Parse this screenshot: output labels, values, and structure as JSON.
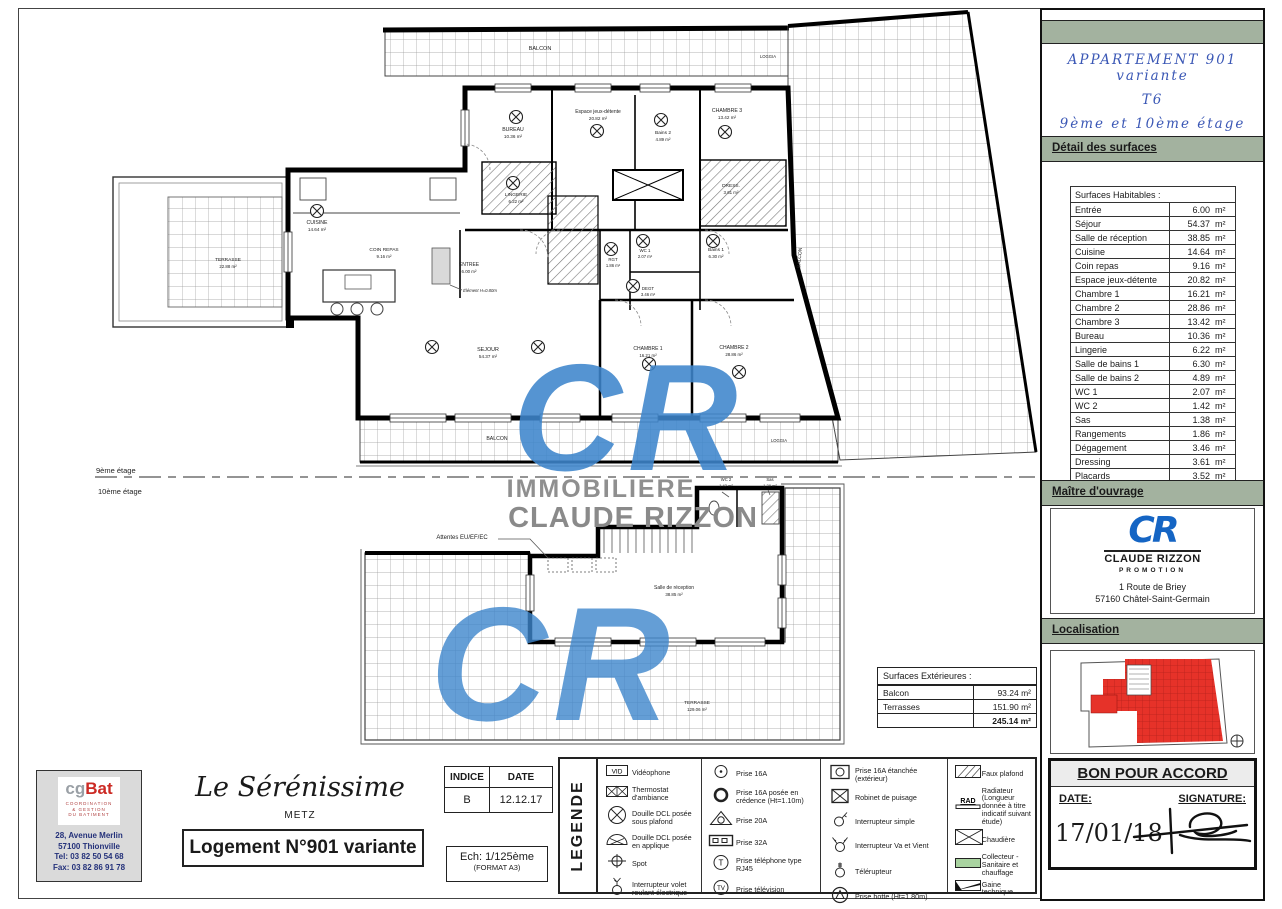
{
  "colors": {
    "band_green": "#a3b29f",
    "title_blue": "#3a57b5",
    "logo_blue": "#1565c4",
    "watermark_blue": "#3e86cc",
    "map_red": "#e63229",
    "gbat_red": "#cc2a24"
  },
  "apartment_title": {
    "line1": "APPARTEMENT 901 variante",
    "line2": "T6",
    "line3": "9ème et 10ème étage"
  },
  "detail_surfaces": {
    "heading": "Détail des surfaces",
    "table_header": "Surfaces Habitables :",
    "unit": "m²",
    "rows": [
      {
        "l": "Entrée",
        "v": "6.00"
      },
      {
        "l": "Séjour",
        "v": "54.37"
      },
      {
        "l": "Salle de réception",
        "v": "38.85"
      },
      {
        "l": "Cuisine",
        "v": "14.64"
      },
      {
        "l": "Coin repas",
        "v": "9.16"
      },
      {
        "l": "Espace jeux-détente",
        "v": "20.82"
      },
      {
        "l": "Chambre 1",
        "v": "16.21"
      },
      {
        "l": "Chambre 2",
        "v": "28.86"
      },
      {
        "l": "Chambre 3",
        "v": "13.42"
      },
      {
        "l": "Bureau",
        "v": "10.36"
      },
      {
        "l": "Lingerie",
        "v": "6.22"
      },
      {
        "l": "Salle de bains 1",
        "v": "6.30"
      },
      {
        "l": "Salle de bains 2",
        "v": "4.89"
      },
      {
        "l": "WC 1",
        "v": "2.07"
      },
      {
        "l": "WC 2",
        "v": "1.42"
      },
      {
        "l": "Sas",
        "v": "1.38"
      },
      {
        "l": "Rangements",
        "v": "1.86"
      },
      {
        "l": "Dégagement",
        "v": "3.46"
      },
      {
        "l": "Dressing",
        "v": "3.61"
      },
      {
        "l": "Placards",
        "v": "3.52"
      }
    ],
    "total": "247.42"
  },
  "maitre_ouvrage": {
    "heading": "Maître d'ouvrage",
    "logo": "CR",
    "company": "CLAUDE RIZZON",
    "company_sub": "PROMOTION",
    "address1": "1 Route de Briey",
    "address2": "57160 Châtel-Saint-Germain"
  },
  "localisation": {
    "heading": "Localisation"
  },
  "bon_pour_accord": {
    "heading": "BON POUR ACCORD",
    "date_label": "DATE:",
    "signature_label": "SIGNATURE:",
    "date_value": "17/01/18"
  },
  "title_block": {
    "gbat": {
      "logo_cg": "cg",
      "logo_bat": "Bat",
      "sub1": "COORDINATION",
      "sub2": "& GESTION",
      "sub3": "DU BATIMENT",
      "addr1": "28, Avenue Merlin",
      "addr2": "57100 Thionville",
      "addr3": "Tel: 03 82 50 54 68",
      "addr4": "Fax: 03 82 86 91 78"
    },
    "project": {
      "name": "Le Sérénissime",
      "city": "METZ",
      "logement": "Logement N°901 variante"
    },
    "indice": {
      "h1": "INDICE",
      "h2": "DATE",
      "v1": "B",
      "v2": "12.12.17"
    },
    "scale": {
      "line1": "Ech: 1/125ème",
      "line2": "(FORMAT A3)"
    },
    "legende_label": "LEGENDE",
    "glyphs": {
      "vid": "VID",
      "tel": "T",
      "tv": "TV",
      "rad": "RAD"
    },
    "legend": {
      "c1": [
        {
          "label": "Vidéophone"
        },
        {
          "label": "Thermostat d'ambiance"
        },
        {
          "label": "Douille DCL posée sous plafond"
        },
        {
          "label": "Douille DCL posée en applique"
        },
        {
          "label": "Spot"
        },
        {
          "label": "Interrupteur volet roulant électrique"
        }
      ],
      "c2": [
        {
          "label": "Prise 16A"
        },
        {
          "label": "Prise 16A posée en crédence (Ht=1.10m)"
        },
        {
          "label": "Prise 20A"
        },
        {
          "label": "Prise 32A"
        },
        {
          "label": "Prise téléphone type RJ45"
        },
        {
          "label": "Prise télévision"
        }
      ],
      "c3": [
        {
          "label": "Prise 16A étanchée (extérieur)"
        },
        {
          "label": "Robinet de puisage"
        },
        {
          "label": "Interrupteur simple"
        },
        {
          "label": "Interrupteur Va et Vient"
        },
        {
          "label": "Télérupteur"
        },
        {
          "label": "Prise hotte (Ht=1.80m)"
        }
      ],
      "c4": [
        {
          "label": "Faux plafond"
        },
        {
          "label": "Radiateur (Longueur donnée à titre indicatif suivant étude)"
        },
        {
          "label": "Chaudière"
        },
        {
          "label": "Collecteur - Sanitaire et chauffage"
        },
        {
          "label": "Gaine technique"
        }
      ]
    }
  },
  "plan": {
    "floor9_label": "9ème étage",
    "floor10_label": "10ème étage",
    "attentes_label": "Attentes EU/EF/EC",
    "element_label": "Élément H=0.80m",
    "labels": {
      "balcon_top": "BALCON",
      "balcon_bottom": "BALCON",
      "balcon_side": "BALCON",
      "loggia_top": "LOGGIA",
      "loggia_bottom": "LOGGIA",
      "terrasse9": "TERRASSE",
      "terrasse9_area": "22.88 m²",
      "terrasse10": "TERRASSE",
      "terrasse10_area": "129.06 m²"
    },
    "rooms9": {
      "bureau": {
        "name": "BUREAU",
        "area": "10.36 m²"
      },
      "jeux": {
        "name": "Espace jeux-détente",
        "area": "20.82 m²"
      },
      "bains2": {
        "name": "Bains 2",
        "area": "4.89 m²"
      },
      "chambre3": {
        "name": "CHAMBRE 3",
        "area": "13.42 m²"
      },
      "bains1": {
        "name": "Bains 1",
        "area": "6.30 m²"
      },
      "lingerie": {
        "name": "LINGERIE",
        "area": "6.22 m²"
      },
      "dressing": {
        "name": "DRESS.",
        "area": "3.61 m²"
      },
      "cuisine": {
        "name": "CUISINE",
        "area": "14.64 m²"
      },
      "coinrepas": {
        "name": "COIN REPAS",
        "area": "9.16 m²"
      },
      "entree": {
        "name": "ENTREE",
        "area": "6.00 m²"
      },
      "rgt": {
        "name": "RGT",
        "area": "1.86 m²"
      },
      "wc1": {
        "name": "WC 1",
        "area": "2.07 m²"
      },
      "degt": {
        "name": "DEGT",
        "area": "3.46 m²"
      },
      "sejour": {
        "name": "SEJOUR",
        "area": "54.37 m²"
      },
      "chambre1": {
        "name": "CHAMBRE 1",
        "area": "16.21 m²"
      },
      "chambre2": {
        "name": "CHAMBRE 2",
        "area": "28.86 m²"
      }
    },
    "rooms10": {
      "salle": {
        "name": "Salle de réception",
        "area": "38.85 m²"
      },
      "wc2": {
        "name": "WC 2",
        "area": "1.42 m²"
      },
      "sas": {
        "name": "Sas",
        "area": "1.38 m²"
      }
    },
    "ext_table": {
      "header": "Surfaces Extérieures :",
      "rows": [
        {
          "l": "Balcon",
          "v": "93.24 m²"
        },
        {
          "l": "Terrasses",
          "v": "151.90 m²"
        }
      ],
      "total": "245.14 m²"
    },
    "watermark": {
      "big": "CR",
      "line1": "IMMOBILIERE",
      "line2": "CLAUDE RIZZON"
    }
  }
}
